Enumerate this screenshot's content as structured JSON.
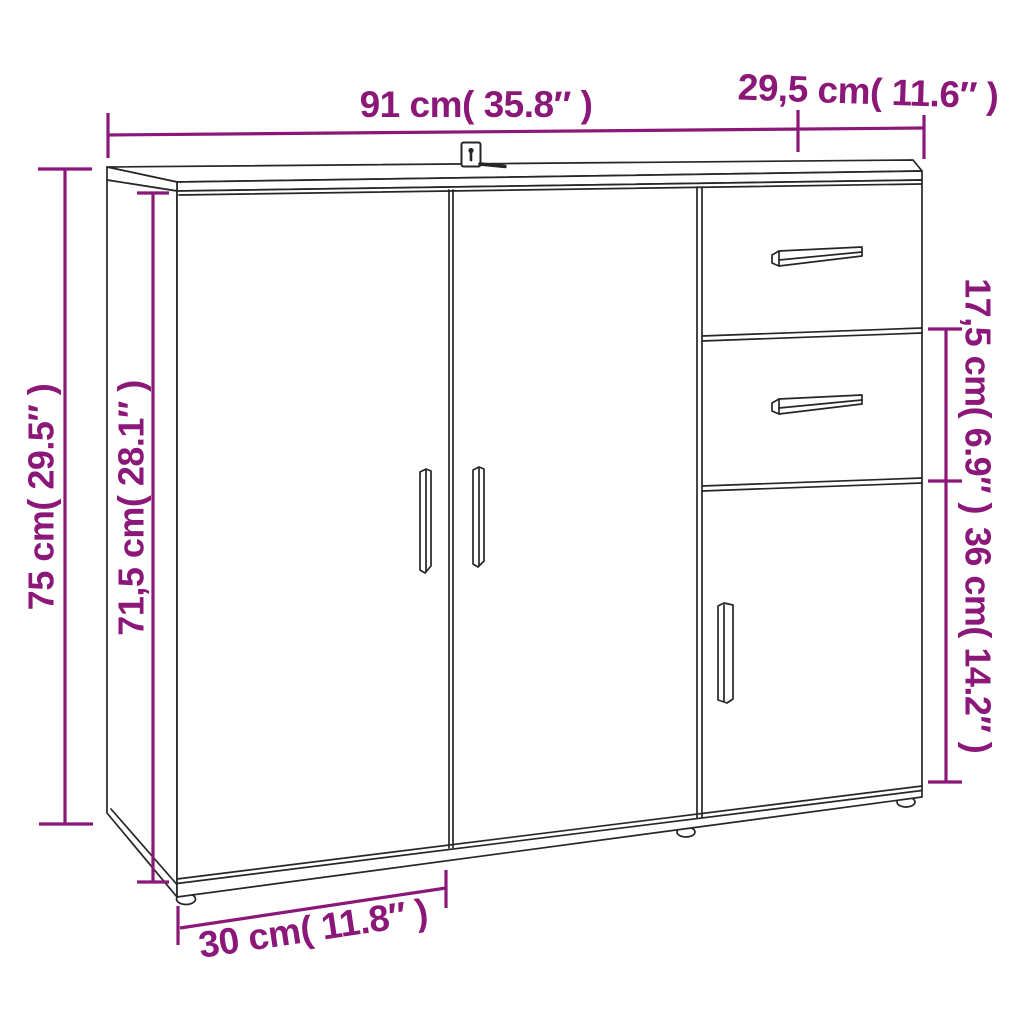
{
  "diagram": {
    "type": "product-dimension-diagram",
    "product": "sideboard-with-2-doors-2-drawers-1-door",
    "colors": {
      "dimension": "#8B1879",
      "outline": "#262626",
      "background": "#ffffff"
    },
    "dimensions": {
      "width": {
        "label": "91 cm( 35.8″ )"
      },
      "depth_top": {
        "label": "29,5 cm( 11.6″ )"
      },
      "height_total": {
        "label": "75 cm( 29.5″ )"
      },
      "height_inner": {
        "label": "71,5 cm( 28.1″ )"
      },
      "drawer_section": {
        "label": "17,5 cm( 6.9″ )"
      },
      "door_section": {
        "label": "36 cm( 14.2″ )"
      },
      "depth_bottom": {
        "label": "30 cm( 11.8″ )"
      }
    }
  }
}
